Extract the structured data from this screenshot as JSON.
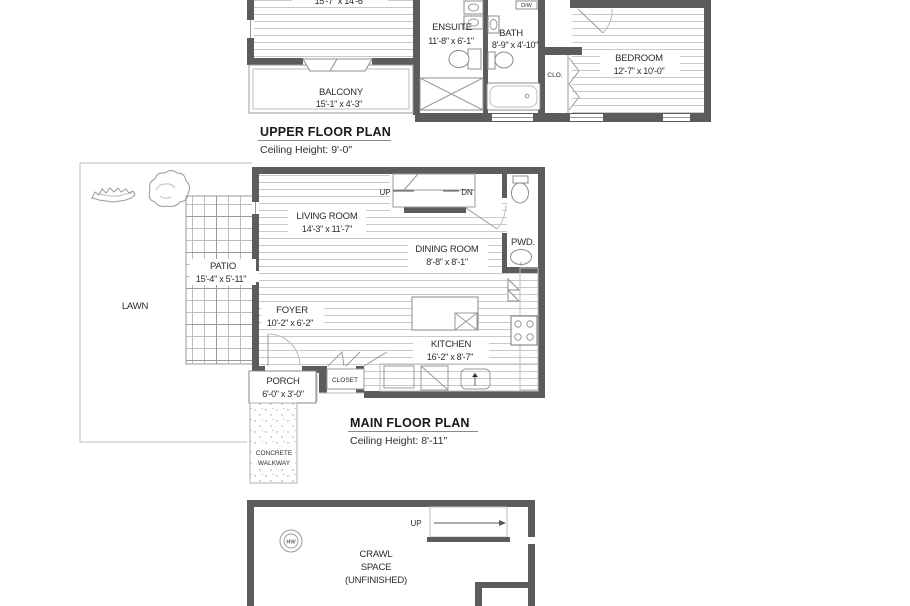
{
  "upper": {
    "title": "UPPER FLOOR PLAN",
    "ceiling": "Ceiling Height: 9'-0\"",
    "master_dims": "15'-7\" x 14'-6\"",
    "balcony": {
      "name": "BALCONY",
      "dims": "15'-1\" x 4'-3\""
    },
    "ensuite": {
      "name": "ENSUITE",
      "dims": "11'-8\" x 6'-1\""
    },
    "bath": {
      "name": "BATH",
      "dims": "8'-9\" x 4'-10\""
    },
    "closet": {
      "name": "CLO."
    },
    "bedroom": {
      "name": "BEDROOM",
      "dims": "12'-7\" x 10'-0\""
    },
    "appliance": {
      "name": "D/W"
    }
  },
  "main": {
    "title": "MAIN FLOOR PLAN",
    "ceiling": "Ceiling Height: 8'-11\"",
    "living": {
      "name": "LIVING ROOM",
      "dims": "14'-3\" x 11'-7\""
    },
    "dining": {
      "name": "DINING ROOM",
      "dims": "8'-8\" x 8'-1\""
    },
    "powder": {
      "name": "PWD."
    },
    "foyer": {
      "name": "FOYER",
      "dims": "10'-2\" x 6'-2\""
    },
    "kitchen": {
      "name": "KITCHEN",
      "dims": "16'-2\" x 8'-7\""
    },
    "closet": {
      "name": "CLOSET"
    },
    "porch": {
      "name": "PORCH",
      "dims": "6'-0\" x 3'-0\""
    },
    "patio": {
      "name": "PATIO",
      "dims": "15'-4\" x 5'-11\""
    },
    "lawn": {
      "name": "LAWN"
    },
    "walkway": {
      "line1": "CONCRETE",
      "line2": "WALKWAY"
    },
    "stairs": {
      "up": "UP",
      "down": "DN"
    }
  },
  "crawl": {
    "line1": "CRAWL",
    "line2": "SPACE",
    "line3": "(UNFINISHED)",
    "stairs": {
      "up": "UP"
    },
    "hw": "HW"
  },
  "colors": {
    "wall": "#5c5c5c",
    "line": "#9a9a9a",
    "floor_line": "#c9c9c9",
    "text": "#2b2b2b"
  }
}
